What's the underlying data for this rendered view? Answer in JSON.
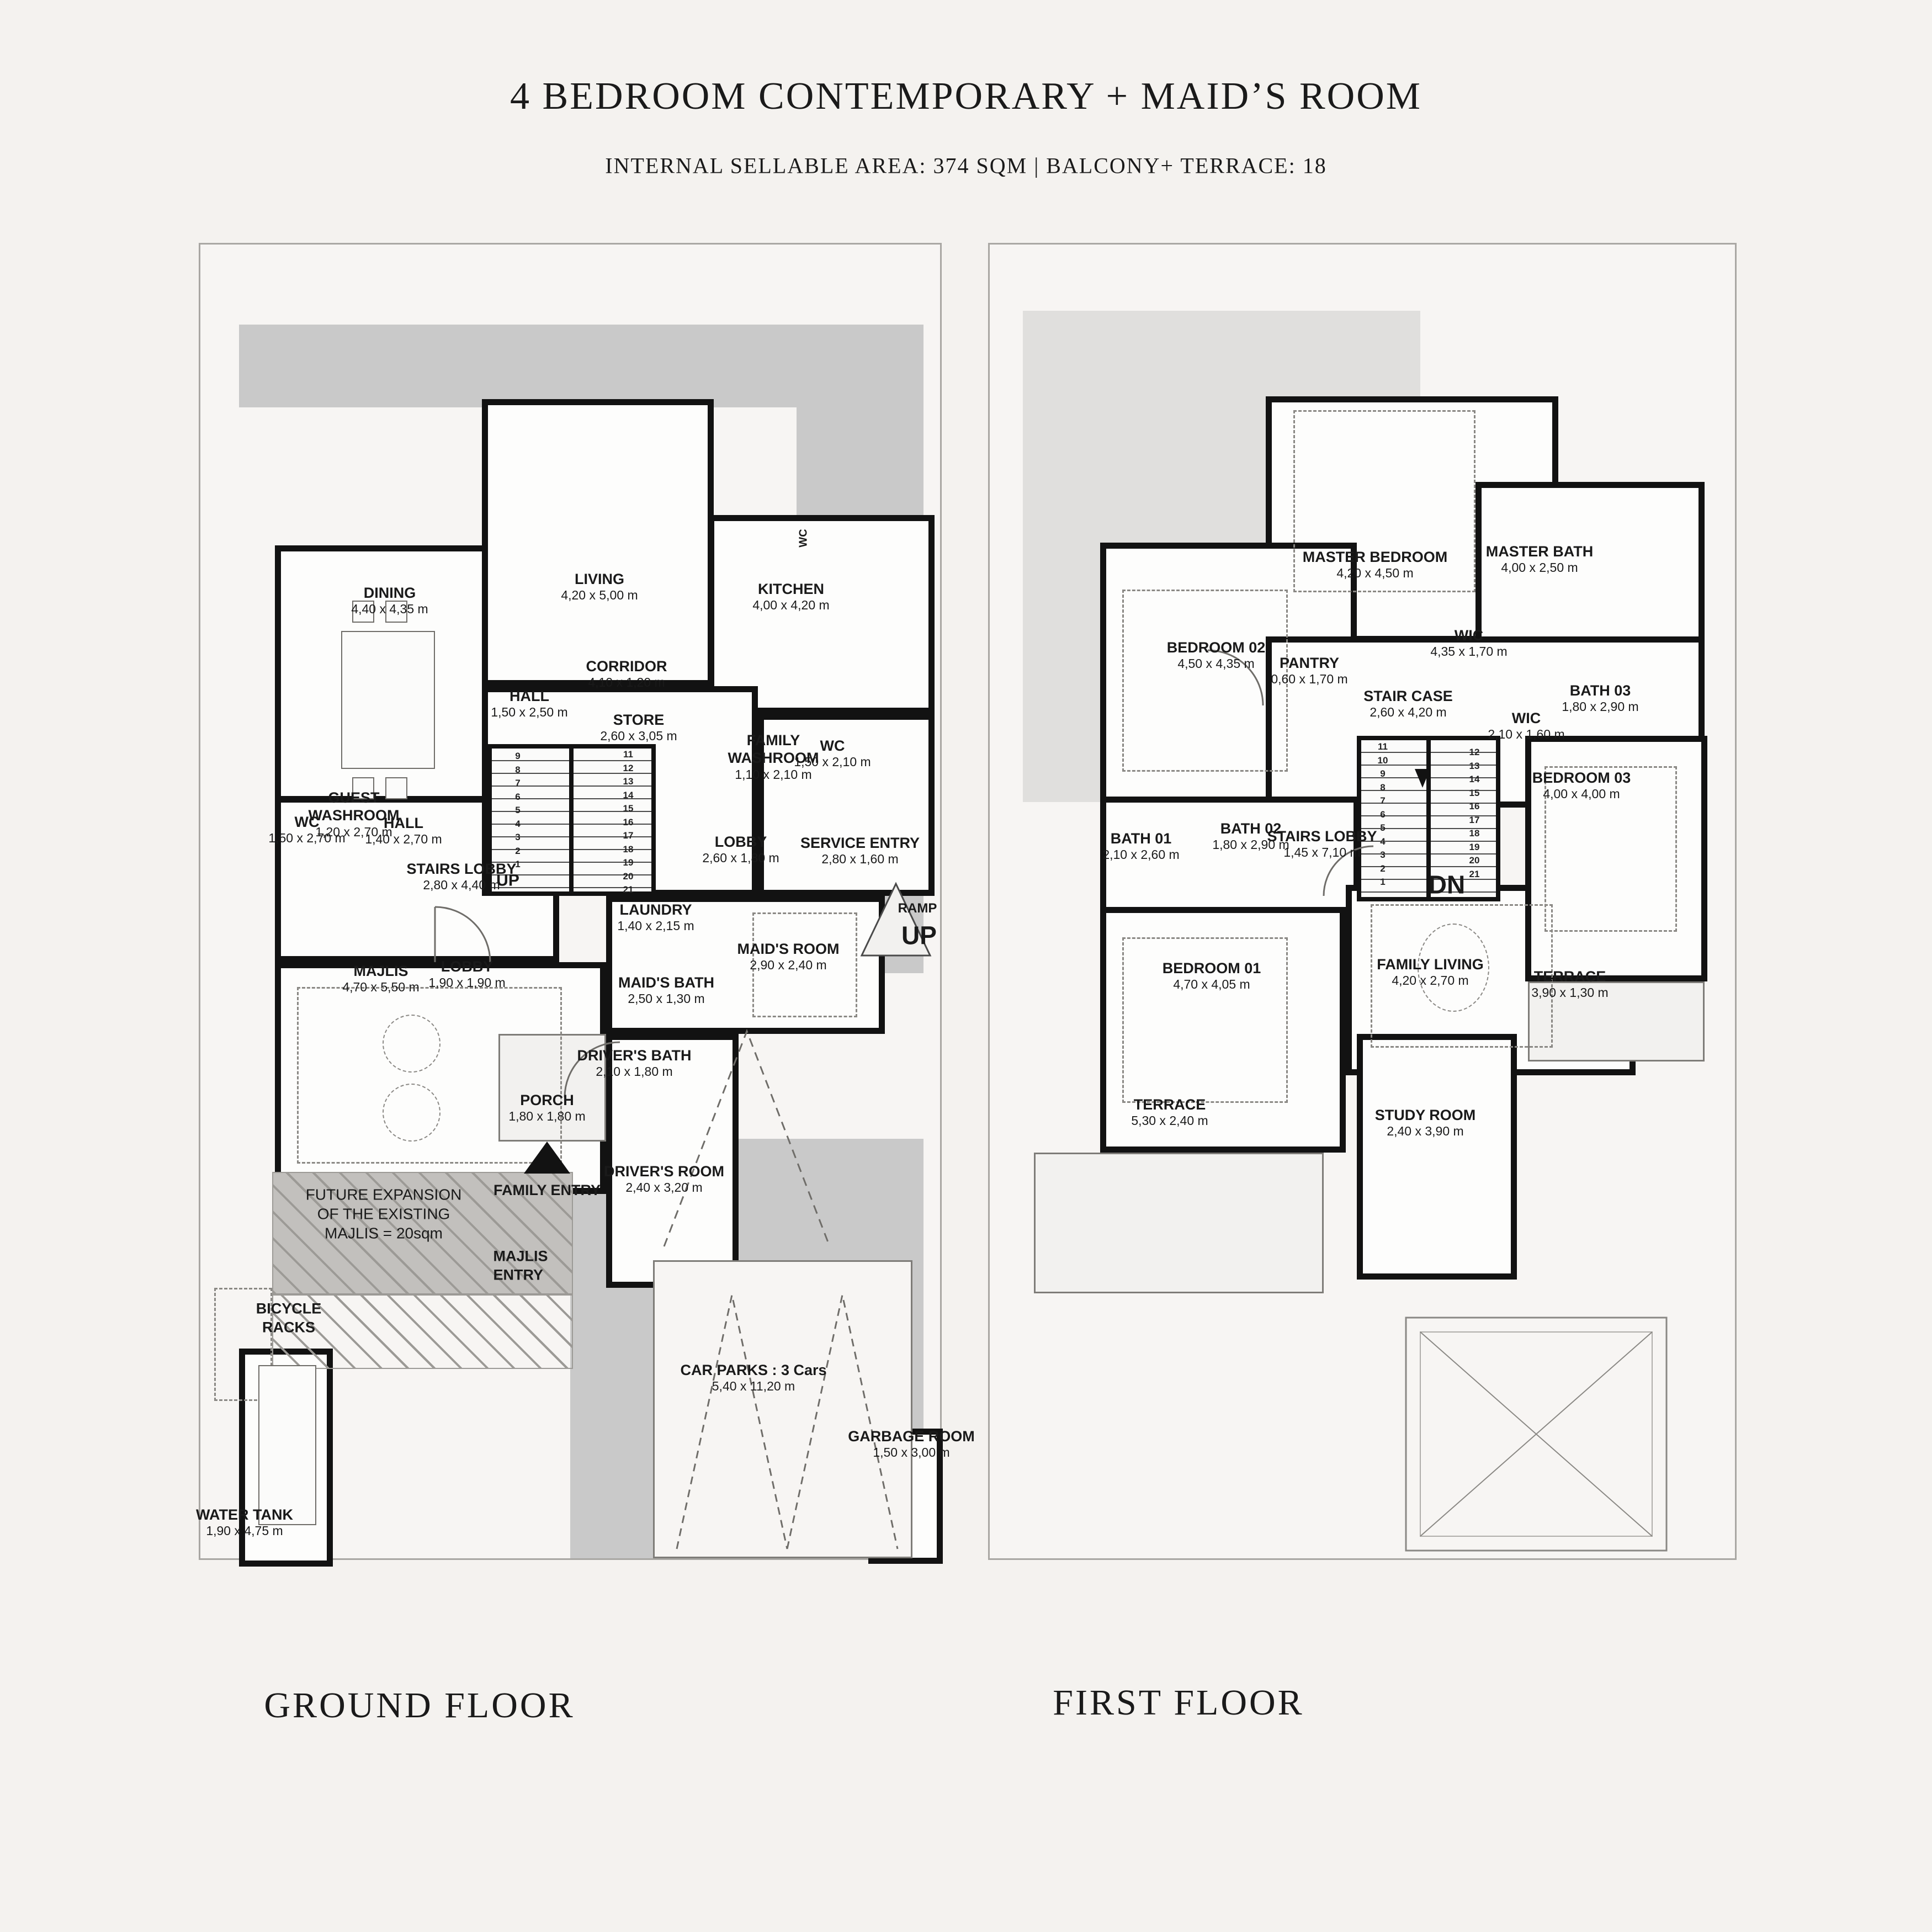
{
  "header": {
    "title": "4 BEDROOM CONTEMPORARY + MAID’S ROOM",
    "subtitle": "INTERNAL SELLABLE AREA: 374 SQM | BALCONY+ TERRACE: 18"
  },
  "colors": {
    "paper": "#f4f2ef",
    "wall": "#121212",
    "driveway": "#c9c9c9",
    "light_shade": "#e0dfdd"
  },
  "ground": {
    "caption": "GROUND FLOOR",
    "rooms": [
      {
        "name": "DINING",
        "dim": "4,40 x 4,35 m"
      },
      {
        "name": "LIVING",
        "dim": "4,20 x 5,00 m"
      },
      {
        "name": "KITCHEN",
        "dim": "4,00 x 4,20 m"
      },
      {
        "name": "CORRIDOR",
        "dim": "4,10 x 1,20 m"
      },
      {
        "name": "HALL",
        "dim": "1,50 x 2,50 m"
      },
      {
        "name": "STORE",
        "dim": "2,60 x 3,05 m"
      },
      {
        "name": "FAMILY\nWASHROOM",
        "dim": "1,10 x 2,10 m"
      },
      {
        "name": "WC",
        "dim": "1,50 x 2,10 m"
      },
      {
        "name": "WC",
        "dim": "1,50 x 2,70 m"
      },
      {
        "name": "GUEST\nWASHROOM",
        "dim": "1,20 x 2,70 m"
      },
      {
        "name": "HALL",
        "dim": "1,40 x 2,70 m"
      },
      {
        "name": "STAIRS LOBBY",
        "dim": "2,80 x 4,40 m"
      },
      {
        "name": "MAJLIS",
        "dim": "4,70 x 5,50 m"
      },
      {
        "name": "LOBBY",
        "dim": "1,90 x 1,90 m"
      },
      {
        "name": "LOBBY",
        "dim": "2,60 x 1,80 m"
      },
      {
        "name": "SERVICE ENTRY",
        "dim": "2,80 x 1,60 m"
      },
      {
        "name": "LAUNDRY",
        "dim": "1,40 x 2,15 m"
      },
      {
        "name": "MAID'S ROOM",
        "dim": "2,90 x 2,40 m"
      },
      {
        "name": "MAID'S BATH",
        "dim": "2,50 x 1,30 m"
      },
      {
        "name": "DRIVER'S BATH",
        "dim": "2,10 x 1,80 m"
      },
      {
        "name": "PORCH",
        "dim": "1,80 x 1,80 m"
      },
      {
        "name": "DRIVER'S ROOM",
        "dim": "2,40 x 3,20 m"
      },
      {
        "name": "CAR PARKS : 3 Cars",
        "dim": "5,40 x 11,20 m"
      },
      {
        "name": "GARBAGE ROOM",
        "dim": "1,50 x 3,00 m"
      },
      {
        "name": "WATER TANK",
        "dim": "1,90 x 4,75 m"
      }
    ],
    "annotations": {
      "stairs_up": "UP",
      "ramp_line1": "RAMP",
      "ramp_line2": "UP",
      "family_entry": "FAMILY ENTRY",
      "majlis_entry": "MAJLIS\nENTRY",
      "bicycle_racks": "BICYCLE\nRACKS",
      "future_expansion": "FUTURE EXPANSION\nOF THE EXISTING\nMAJLIS = 20sqm",
      "small_wc": "WC"
    },
    "stair_numbers_left": "9\n8\n7\n6\n5\n4\n3\n2\n1",
    "stair_numbers_right": "11\n12\n13\n14\n15\n16\n17\n18\n19\n20\n21"
  },
  "first": {
    "caption": "FIRST FLOOR",
    "rooms": [
      {
        "name": "MASTER BEDROOM",
        "dim": "4,20 x 4,50 m"
      },
      {
        "name": "MASTER BATH",
        "dim": "4,00 x 2,50 m"
      },
      {
        "name": "WIC",
        "dim": "4,35 x 1,70 m"
      },
      {
        "name": "PANTRY",
        "dim": "0,60 x 1,70 m"
      },
      {
        "name": "STAIR CASE",
        "dim": "2,60 x 4,20 m"
      },
      {
        "name": "WIC",
        "dim": "2,10 x 1,60 m"
      },
      {
        "name": "BATH 03",
        "dim": "1,80 x 2,90 m"
      },
      {
        "name": "BEDROOM 02",
        "dim": "4,50 x 4,35 m"
      },
      {
        "name": "BATH 01",
        "dim": "2,10 x 2,60 m"
      },
      {
        "name": "BATH 02",
        "dim": "1,80 x 2,90 m"
      },
      {
        "name": "STAIRS LOBBY",
        "dim": "1,45 x 7,10 m"
      },
      {
        "name": "BEDROOM 01",
        "dim": "4,70 x 4,05 m"
      },
      {
        "name": "FAMILY LIVING",
        "dim": "4,20 x 2,70 m"
      },
      {
        "name": "TERRACE",
        "dim": "5,30 x 2,40 m"
      },
      {
        "name": "STUDY ROOM",
        "dim": "2,40 x 3,90 m"
      },
      {
        "name": "BEDROOM 03",
        "dim": "4,00 x 4,00 m"
      },
      {
        "name": "TERRACE",
        "dim": "3,90 x 1,30 m"
      }
    ],
    "annotations": {
      "stairs_down": "DN"
    },
    "stair_numbers_left": "11\n10\n9\n8\n7\n6\n5\n4\n3\n2\n1",
    "stair_numbers_right": "12\n13\n14\n15\n16\n17\n18\n19\n20\n21"
  }
}
